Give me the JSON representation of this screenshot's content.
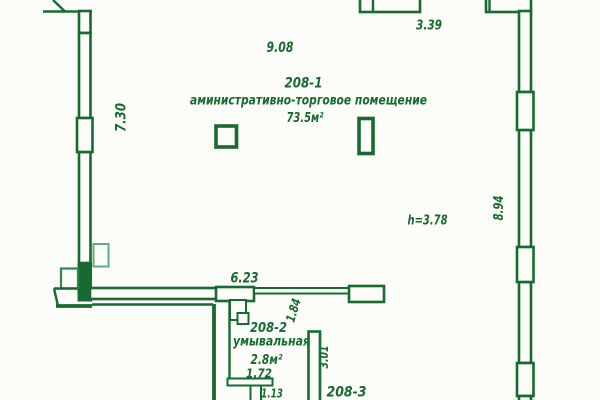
{
  "plan": {
    "colors": {
      "ink": "#176a31",
      "ink_mid": "#2f8650",
      "ink_light": "#5fae7f",
      "paper": "#fcfcf8"
    },
    "room_main": {
      "number": "208-1",
      "name": "аминистративно-торговое помещение",
      "area": "73.5м²",
      "height_note": "h=3.78"
    },
    "room_wash": {
      "number": "208-2",
      "name": "умывальная",
      "area": "2.8м²"
    },
    "room_3": {
      "number": "208-3"
    },
    "dims": {
      "top_span": "9.08",
      "top_right_window": "3.39",
      "left_span": "7.30",
      "right_span": "8.94",
      "bottom_span": "6.23",
      "door_offset": "1.84",
      "wash_width": "1.72",
      "wash_door": "1.13",
      "wash_depth": "3.01"
    }
  }
}
